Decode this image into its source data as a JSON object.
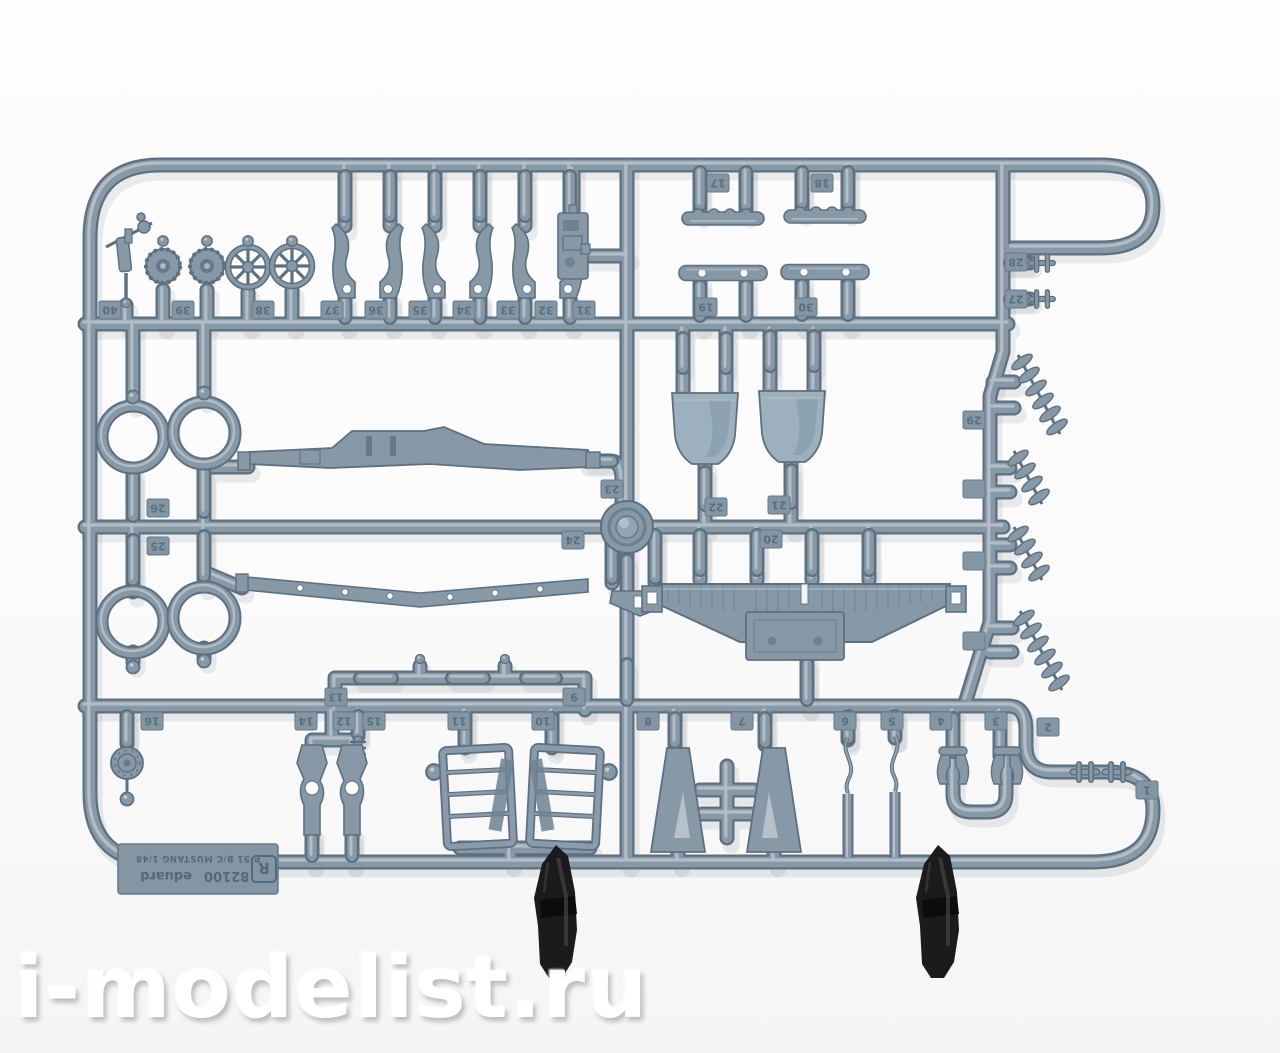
{
  "watermark": {
    "text": "i-modelist.ru"
  },
  "sprue": {
    "label": {
      "code": "82100",
      "brand": "eduard",
      "kit": "P-51 B/C MUSTANG 1/48",
      "letter": "R"
    },
    "tabs": {
      "t1": "1",
      "t2": "2",
      "t3": "3",
      "t4": "4",
      "t5": "5",
      "t6": "6",
      "t7": "7",
      "t8": "8",
      "t9": "9",
      "t10": "10",
      "t11": "11",
      "t12": "12",
      "t13": "13",
      "t14": "14",
      "t15": "15",
      "t16": "16",
      "t17": "17",
      "t18": "18",
      "t19": "19",
      "t20": "20",
      "t21": "21",
      "t22": "22",
      "t23": "23",
      "t24": "24",
      "t25": "25",
      "t26": "26",
      "t27": "27",
      "t28": "28",
      "t29": "29",
      "t30": "30",
      "t31": "31",
      "t32": "32",
      "t33": "33",
      "t34": "34",
      "t35": "35",
      "t36": "36",
      "t37": "37",
      "t38": "38",
      "t39": "39",
      "t40": "40"
    }
  },
  "colors": {
    "plastic_mid": "#8799a7",
    "plastic_dark": "#5c7080",
    "plastic_light": "#b7c2cb",
    "clip_black": "#1b1b1d",
    "background": "#fbfbfb",
    "watermark": "#ffffff"
  }
}
